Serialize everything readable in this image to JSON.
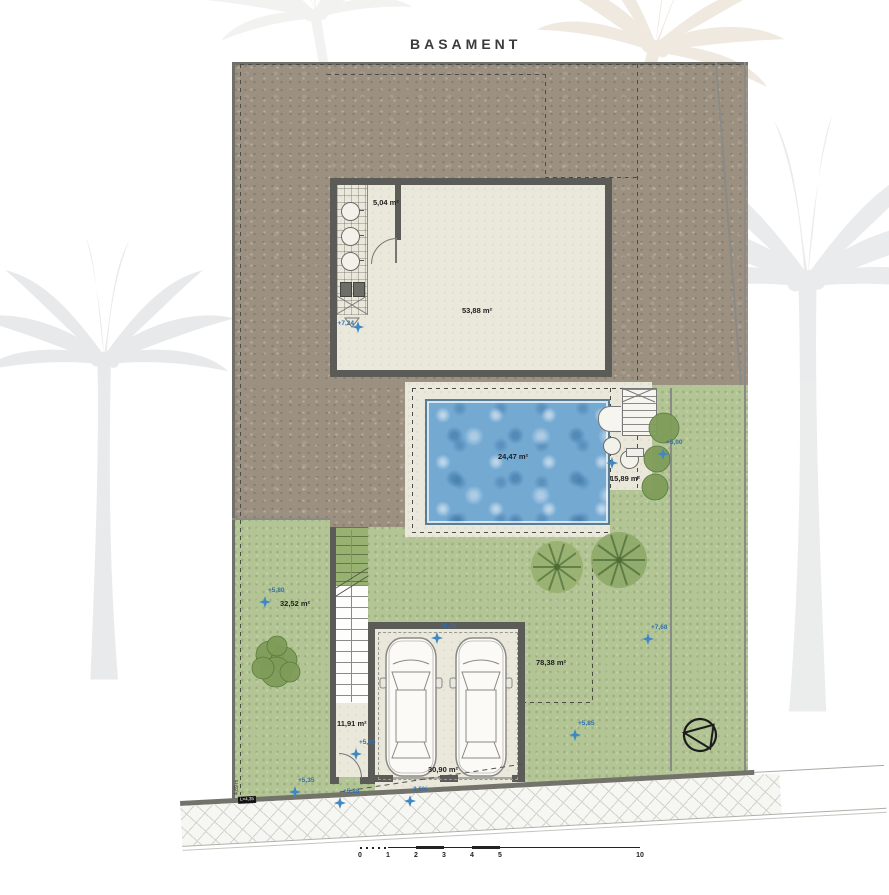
{
  "title": "BASAMENT",
  "plan": {
    "rooms": [
      {
        "id": "installations",
        "label": "5,04 m²"
      },
      {
        "id": "main-room",
        "label": "53,88 m²"
      },
      {
        "id": "pool",
        "label": "24,47 m²"
      },
      {
        "id": "pool-side-deck",
        "label": "15,89 m²"
      },
      {
        "id": "garden-left",
        "label": "32,52 m²"
      },
      {
        "id": "garden-right",
        "label": "78,38 m²"
      },
      {
        "id": "entry-hall",
        "label": "11,91 m²"
      },
      {
        "id": "garage",
        "label": "30,90 m²"
      }
    ],
    "levels": [
      {
        "label": "+7,24"
      },
      {
        "label": "+5,00"
      },
      {
        "label": "+5,80"
      },
      {
        "label": "+6,78"
      },
      {
        "label": "+7,68"
      },
      {
        "label": "+5,85"
      },
      {
        "label": "+5,35"
      },
      {
        "label": "+5,28"
      },
      {
        "label": "+5,86"
      },
      {
        "label": "3,6%"
      }
    ],
    "dimensions": {
      "left_boundary": "4,89 m",
      "curb_chip": "L=4,35"
    }
  },
  "scalebar": {
    "ticks": [
      "0",
      "1",
      "2",
      "3",
      "4",
      "5",
      "10"
    ]
  },
  "icons": [
    "north-arrow-icon",
    "level-marker-star-icon",
    "palm-watermark-icon"
  ],
  "colors": {
    "earth": "#9c9081",
    "grass": "#b3c595",
    "pool_water": "#74a9d2",
    "wall": "#5b5b57",
    "floor": "#eae7db",
    "marker_blue": "#2f6fb0",
    "title_text": "#3b3b3b"
  }
}
